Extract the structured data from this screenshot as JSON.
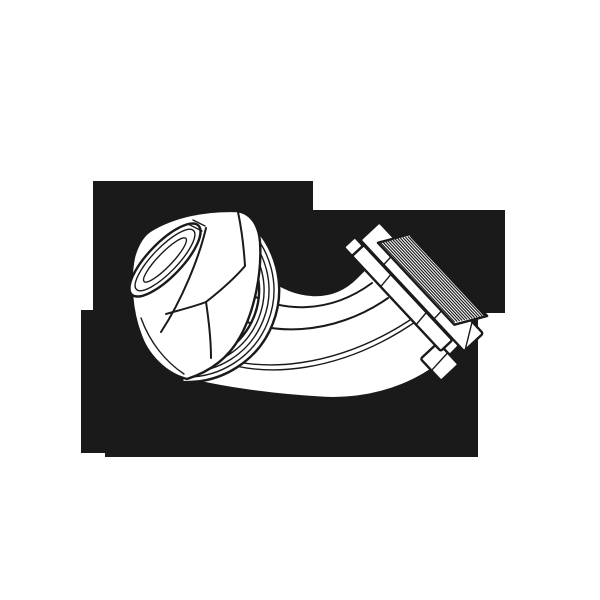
{
  "figure": {
    "description": "Black-and-white technical line drawing of a 45-degree flexible liquid-tight conduit connector elbow, shown in three-quarter view on an irregular black rectangular background. A large hex gland nut with an elliptical opening faces upper-left, a smooth curved elbow tube sweeps through the bottom, and a threaded male end with washer and locknut points to the upper-right.",
    "parts": [
      "gland-hex-nut",
      "conduit-opening",
      "compression-ridges",
      "elbow-tube",
      "sealing-washer",
      "locknut",
      "male-threads",
      "thread-tip"
    ]
  },
  "colors": {
    "paper": "#ffffff",
    "ink": "#1a1a1a"
  },
  "silhouette": {
    "points": "93,181 313,181 313,210 505,210 505,313 478,313 478,457 105,457 105,453 81,453 81,310 93,310"
  }
}
